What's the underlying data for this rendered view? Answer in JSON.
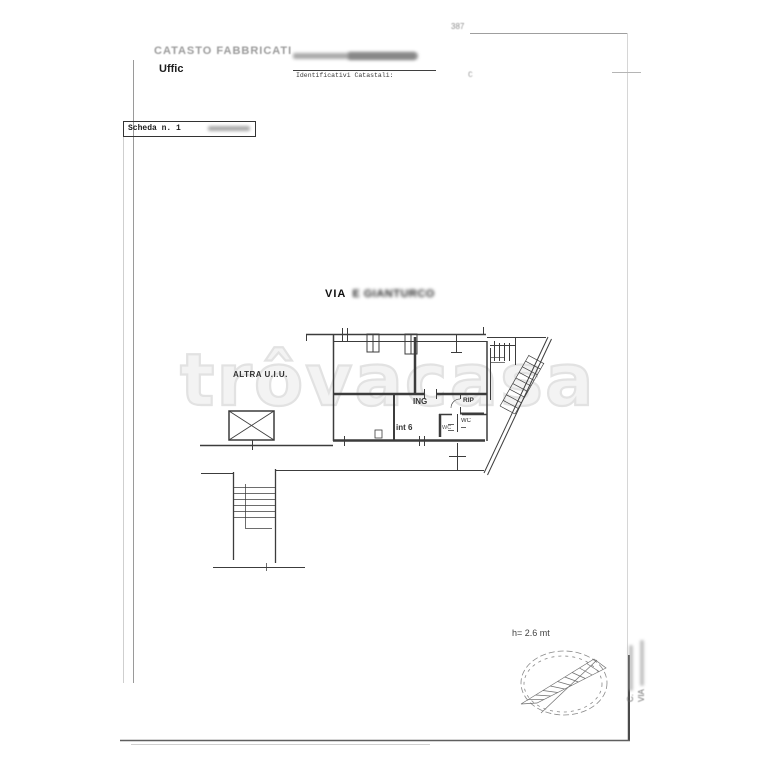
{
  "header": {
    "title": "CATASTO FABBRICATI",
    "office_label": "Uffic",
    "corner_note": "387",
    "catastal_label": "Identificativi Catastali:",
    "catastal_value": "C"
  },
  "scheda": {
    "label": "Scheda n. 1"
  },
  "street": {
    "prefix": "VIA",
    "name_blurred": "E GIANTURCO"
  },
  "plan_labels": {
    "altra_uiu": "ALTRA U.I.U.",
    "ing": "ING",
    "rip": "RIP",
    "wc": "WC",
    "wc_small": "WC",
    "int6": "int 6"
  },
  "notes": {
    "height": "h= 2.6 mt"
  },
  "side_note": {
    "line1": "C.",
    "line2": "VIA"
  },
  "watermark": {
    "text": "trôvacasa"
  },
  "colors": {
    "plan_line": "#3c3c3c",
    "border_faint": "#c9c9c9",
    "watermark": "#e2e2e2",
    "header_gray": "#9b9b9b"
  }
}
